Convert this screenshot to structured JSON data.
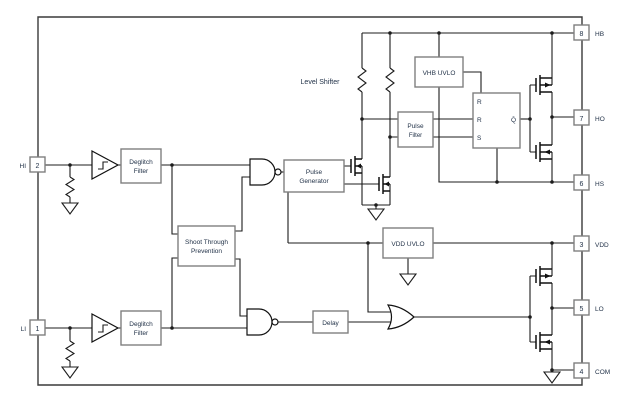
{
  "diagram": {
    "title": "half-bridge gate driver functional block diagram",
    "pins_right": [
      {
        "number": "8",
        "name": "HB"
      },
      {
        "number": "7",
        "name": "HO"
      },
      {
        "number": "6",
        "name": "HS"
      },
      {
        "number": "3",
        "name": "VDD"
      },
      {
        "number": "5",
        "name": "LO"
      },
      {
        "number": "4",
        "name": "COM"
      }
    ],
    "pins_left": [
      {
        "number": "2",
        "name": "HI"
      },
      {
        "number": "1",
        "name": "LI"
      }
    ],
    "blocks": {
      "deglitch_hi": {
        "line1": "Deglitch",
        "line2": "Filter"
      },
      "deglitch_li": {
        "line1": "Deglitch",
        "line2": "Filter"
      },
      "shoot_through": {
        "line1": "Shoot Through",
        "line2": "Prevention"
      },
      "pulse_generator": {
        "line1": "Pulse",
        "line2": "Generator"
      },
      "pulse_filter": {
        "line1": "Pulse",
        "line2": "Filter"
      },
      "vhb_uvlo": {
        "label": "VHB UVLO"
      },
      "vdd_uvlo": {
        "label": "VDD UVLO"
      },
      "delay": {
        "label": "Delay"
      },
      "latch": {
        "in1": "R",
        "in2": "R",
        "in3": "S",
        "out": "Q̄"
      }
    },
    "labels": {
      "level_shifter": "Level Shifter"
    },
    "colors": {
      "wire": "#1c1c1c",
      "block_stroke": "#7f7f7f",
      "text": "#233349",
      "background": "#ffffff"
    }
  }
}
